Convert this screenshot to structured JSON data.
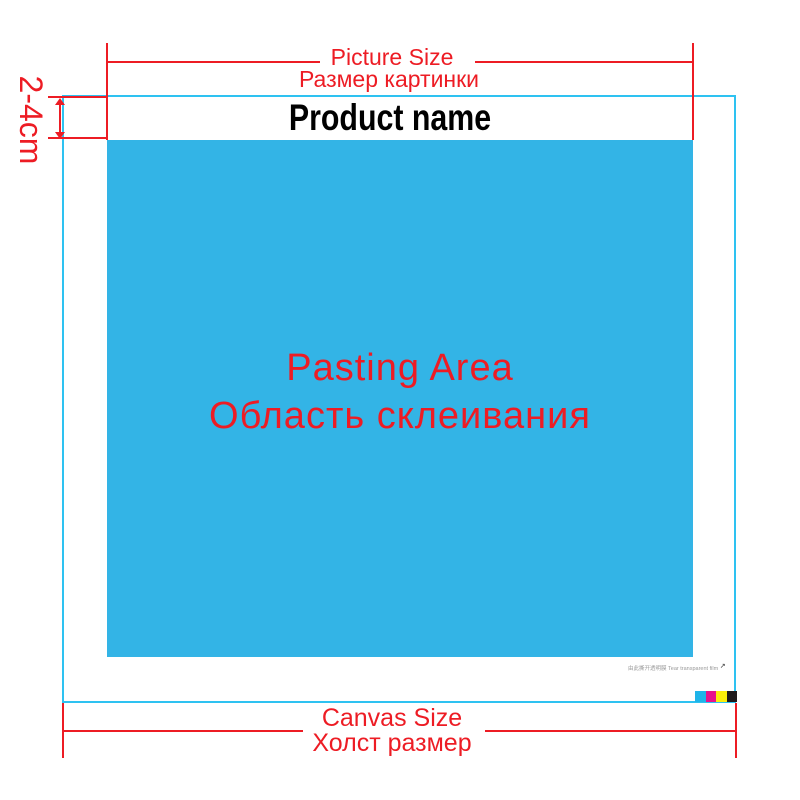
{
  "top_measure": {
    "label_en": "Picture Size",
    "label_ru": "Размер картинки"
  },
  "margin_bracket": {
    "label": "2-4cm"
  },
  "banner": {
    "product_name": "Product name"
  },
  "pasting_area": {
    "label_en": "Pasting Area",
    "label_ru": "Область склеивания"
  },
  "bottom_measure": {
    "label_en": "Canvas Size",
    "label_ru": "Холст размер"
  },
  "footnote": {
    "text": "由此撕开透明膜 Tear transparent film",
    "arrow": "↗"
  },
  "colors": {
    "measure_red": "#ed1c24",
    "pasting_blue": "#33b4e6",
    "canvas_outline_cyan": "#2ec2f1",
    "product_name_black": "#000000",
    "cmyk_bars": [
      "#1fb4e9",
      "#e8128c",
      "#fbee0b",
      "#1e1a1b"
    ]
  },
  "color_bars": {
    "names": [
      "cyan-bar",
      "magenta-bar",
      "yellow-bar",
      "black-bar"
    ]
  }
}
